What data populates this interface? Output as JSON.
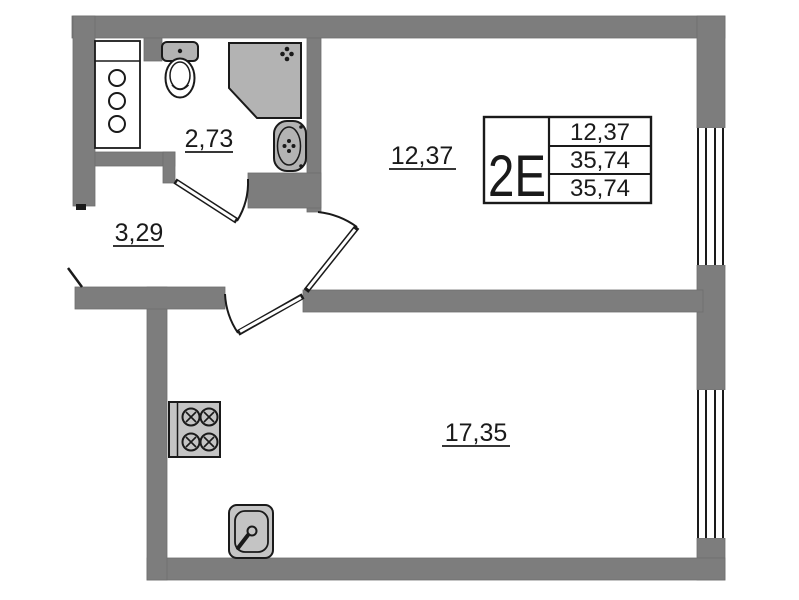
{
  "colors": {
    "wall": "#7d7d7d",
    "line": "#1a1a1a",
    "fixture": "#b3b3b3",
    "appliance": "#c4c4c4",
    "background": "#ffffff"
  },
  "rooms": {
    "bathroom": {
      "area": "2,73"
    },
    "hallway": {
      "area": "3,29"
    },
    "bedroom": {
      "area": "12,37"
    },
    "living_room": {
      "area": "17,35"
    }
  },
  "summary": {
    "unit_type": "2Е",
    "values": [
      "12,37",
      "35,74",
      "35,74"
    ]
  },
  "icons": [
    "bathroom-cabinet-icon",
    "toilet-icon",
    "shower-cabin-icon",
    "washbasin-icon",
    "stove-icon",
    "kitchen-sink-icon",
    "window-icon",
    "door-swing-icon"
  ]
}
